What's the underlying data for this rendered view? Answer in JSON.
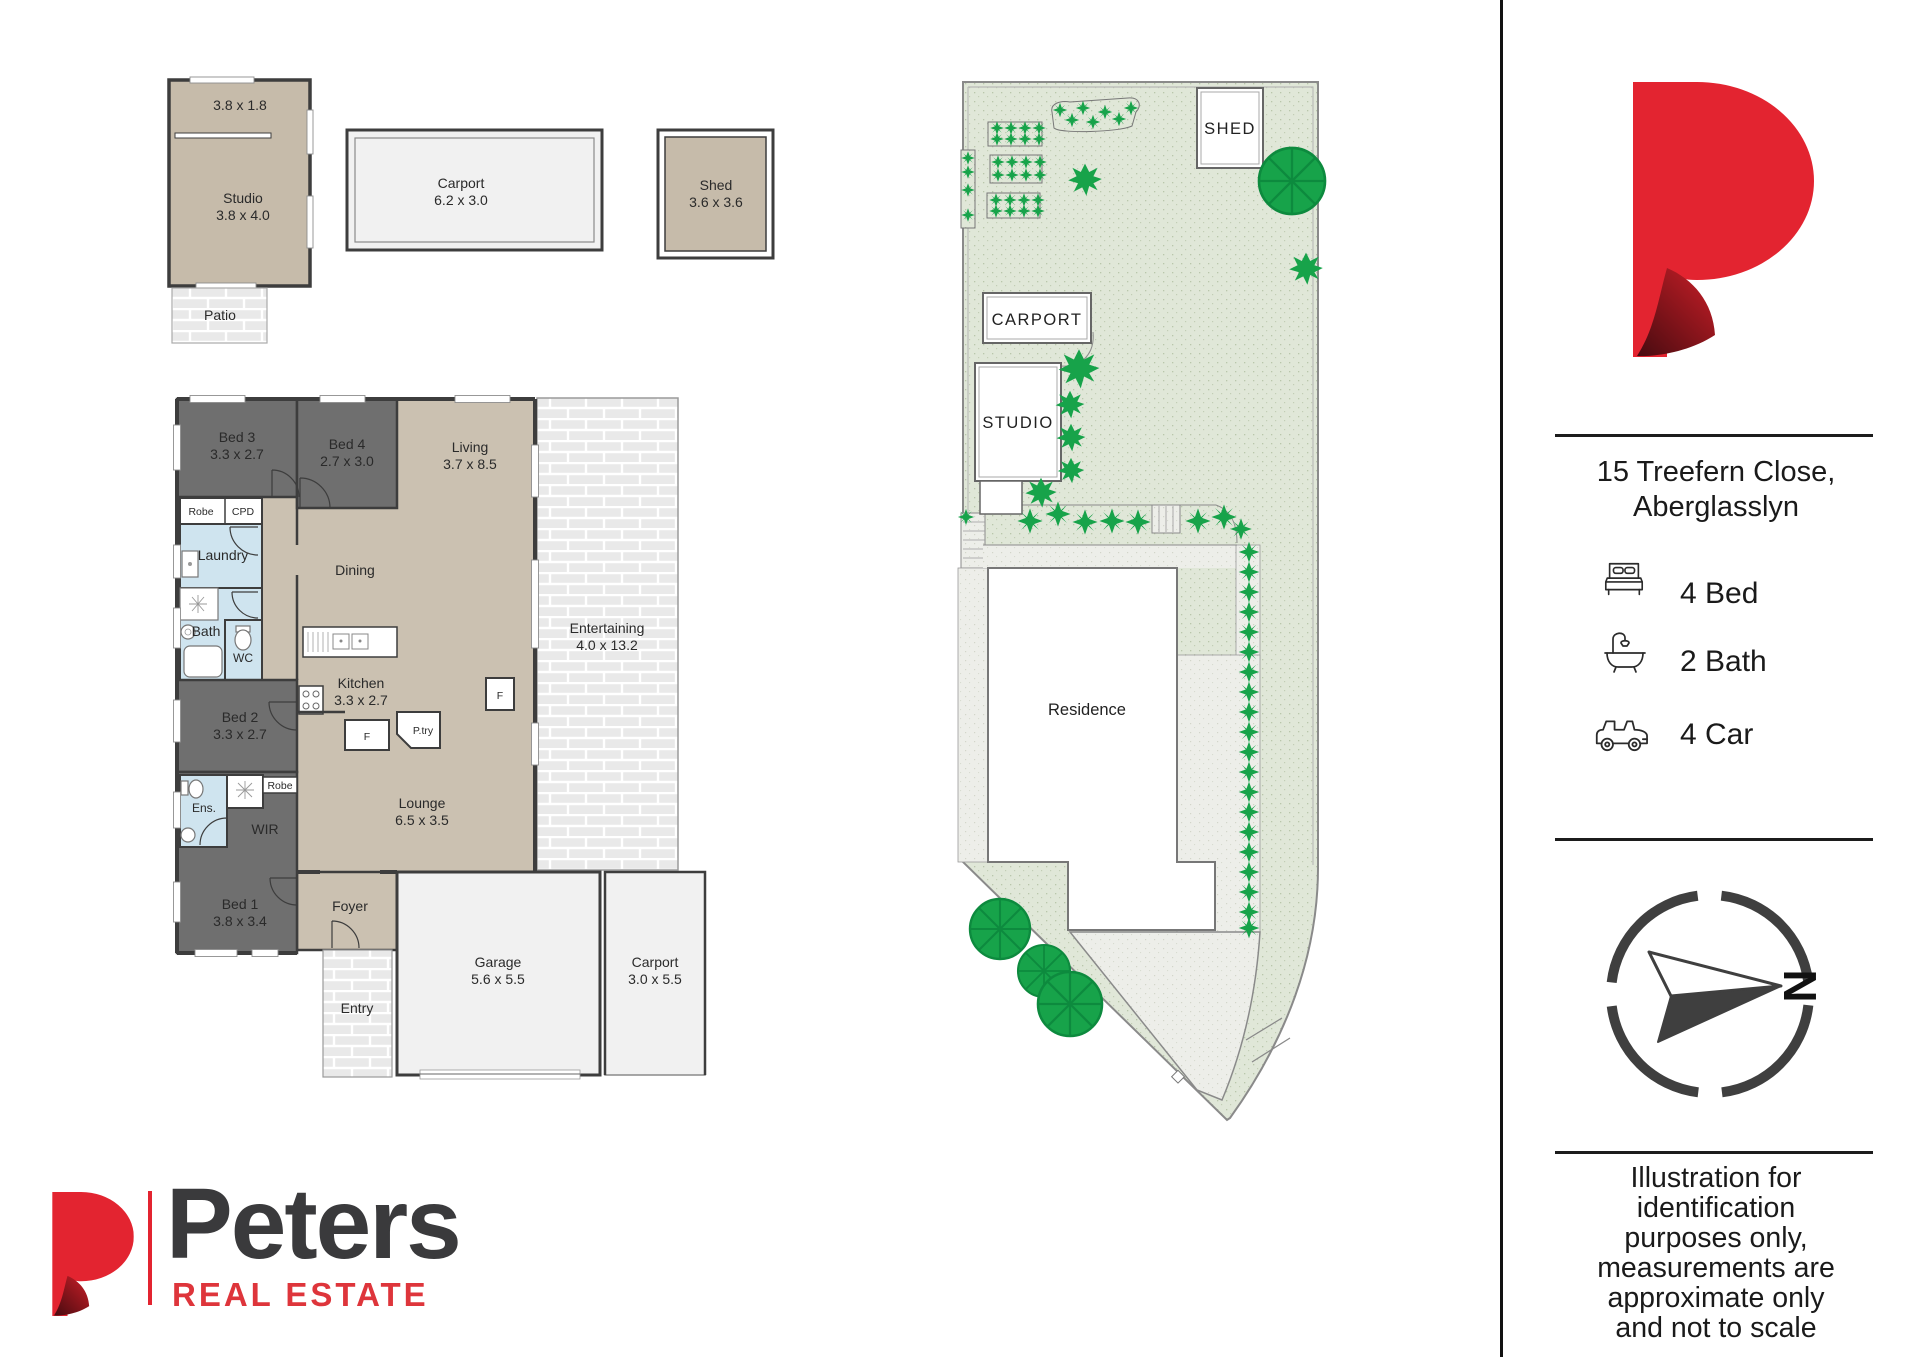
{
  "floor_plan": {
    "studio_building": {
      "upper_dim": "3.8 x 1.8",
      "name": "Studio",
      "dim": "3.8 x 4.0",
      "patio_label": "Patio"
    },
    "detached_carport": {
      "name": "Carport",
      "dim": "6.2 x 3.0"
    },
    "detached_shed": {
      "name": "Shed",
      "dim": "3.6 x 3.6"
    },
    "rooms": {
      "bed3": {
        "name": "Bed 3",
        "dim": "3.3 x 2.7"
      },
      "bed4": {
        "name": "Bed 4",
        "dim": "2.7 x 3.0"
      },
      "living": {
        "name": "Living",
        "dim": "3.7 x 8.5"
      },
      "robe": {
        "name": "Robe"
      },
      "cpd": {
        "name": "CPD"
      },
      "laundry": {
        "name": "Laundry"
      },
      "dining": {
        "name": "Dining"
      },
      "bath": {
        "name": "Bath"
      },
      "wc": {
        "name": "WC"
      },
      "kitchen": {
        "name": "Kitchen",
        "dim": "3.3 x 2.7"
      },
      "fridge": {
        "name": "F"
      },
      "pantry": {
        "name": "P.try"
      },
      "fridge2": {
        "name": "F"
      },
      "entertaining": {
        "name": "Entertaining",
        "dim": "4.0 x 13.2"
      },
      "bed2": {
        "name": "Bed 2",
        "dim": "3.3 x 2.7"
      },
      "ensuite": {
        "name": "Ens."
      },
      "robe2": {
        "name": "Robe"
      },
      "wir": {
        "name": "WIR"
      },
      "bed1": {
        "name": "Bed 1",
        "dim": "3.8 x 3.4"
      },
      "lounge": {
        "name": "Lounge",
        "dim": "6.5 x 3.5"
      },
      "foyer": {
        "name": "Foyer"
      },
      "entry": {
        "name": "Entry"
      },
      "garage": {
        "name": "Garage",
        "dim": "5.6 x 5.5"
      },
      "carport": {
        "name": "Carport",
        "dim": "3.0 x 5.5"
      }
    }
  },
  "site_plan": {
    "shed_label": "SHED",
    "carport_label": "CARPORT",
    "studio_label": "STUDIO",
    "residence_label": "Residence"
  },
  "sidebar": {
    "address_line1": "15 Treefern Close,",
    "address_line2": "Aberglasslyn",
    "features": [
      {
        "icon": "bed-icon",
        "label": "4  Bed"
      },
      {
        "icon": "bath-icon",
        "label": "2 Bath"
      },
      {
        "icon": "car-icon",
        "label": "4 Car"
      }
    ],
    "compass_north": "N",
    "disclaimer_lines": [
      "Illustration for",
      "identification",
      "purposes only,",
      "measurements are",
      "approximate only",
      "and not to scale"
    ]
  },
  "brand": {
    "name": "Peters",
    "tagline": "REAL ESTATE"
  },
  "colors": {
    "brand_red": "#e32430",
    "brand_dark": "#3a3a3c",
    "wall": "#3d3d3d",
    "bedroom_gray": "#6f6f6f",
    "living_tan": "#cbc1b1",
    "studio_tan": "#c6bbaa",
    "wet_blue": "#cfe4ef",
    "garage_gray": "#f1f1f1",
    "grass_green": "#e0e7d8",
    "plant_green": "#17a34a"
  }
}
